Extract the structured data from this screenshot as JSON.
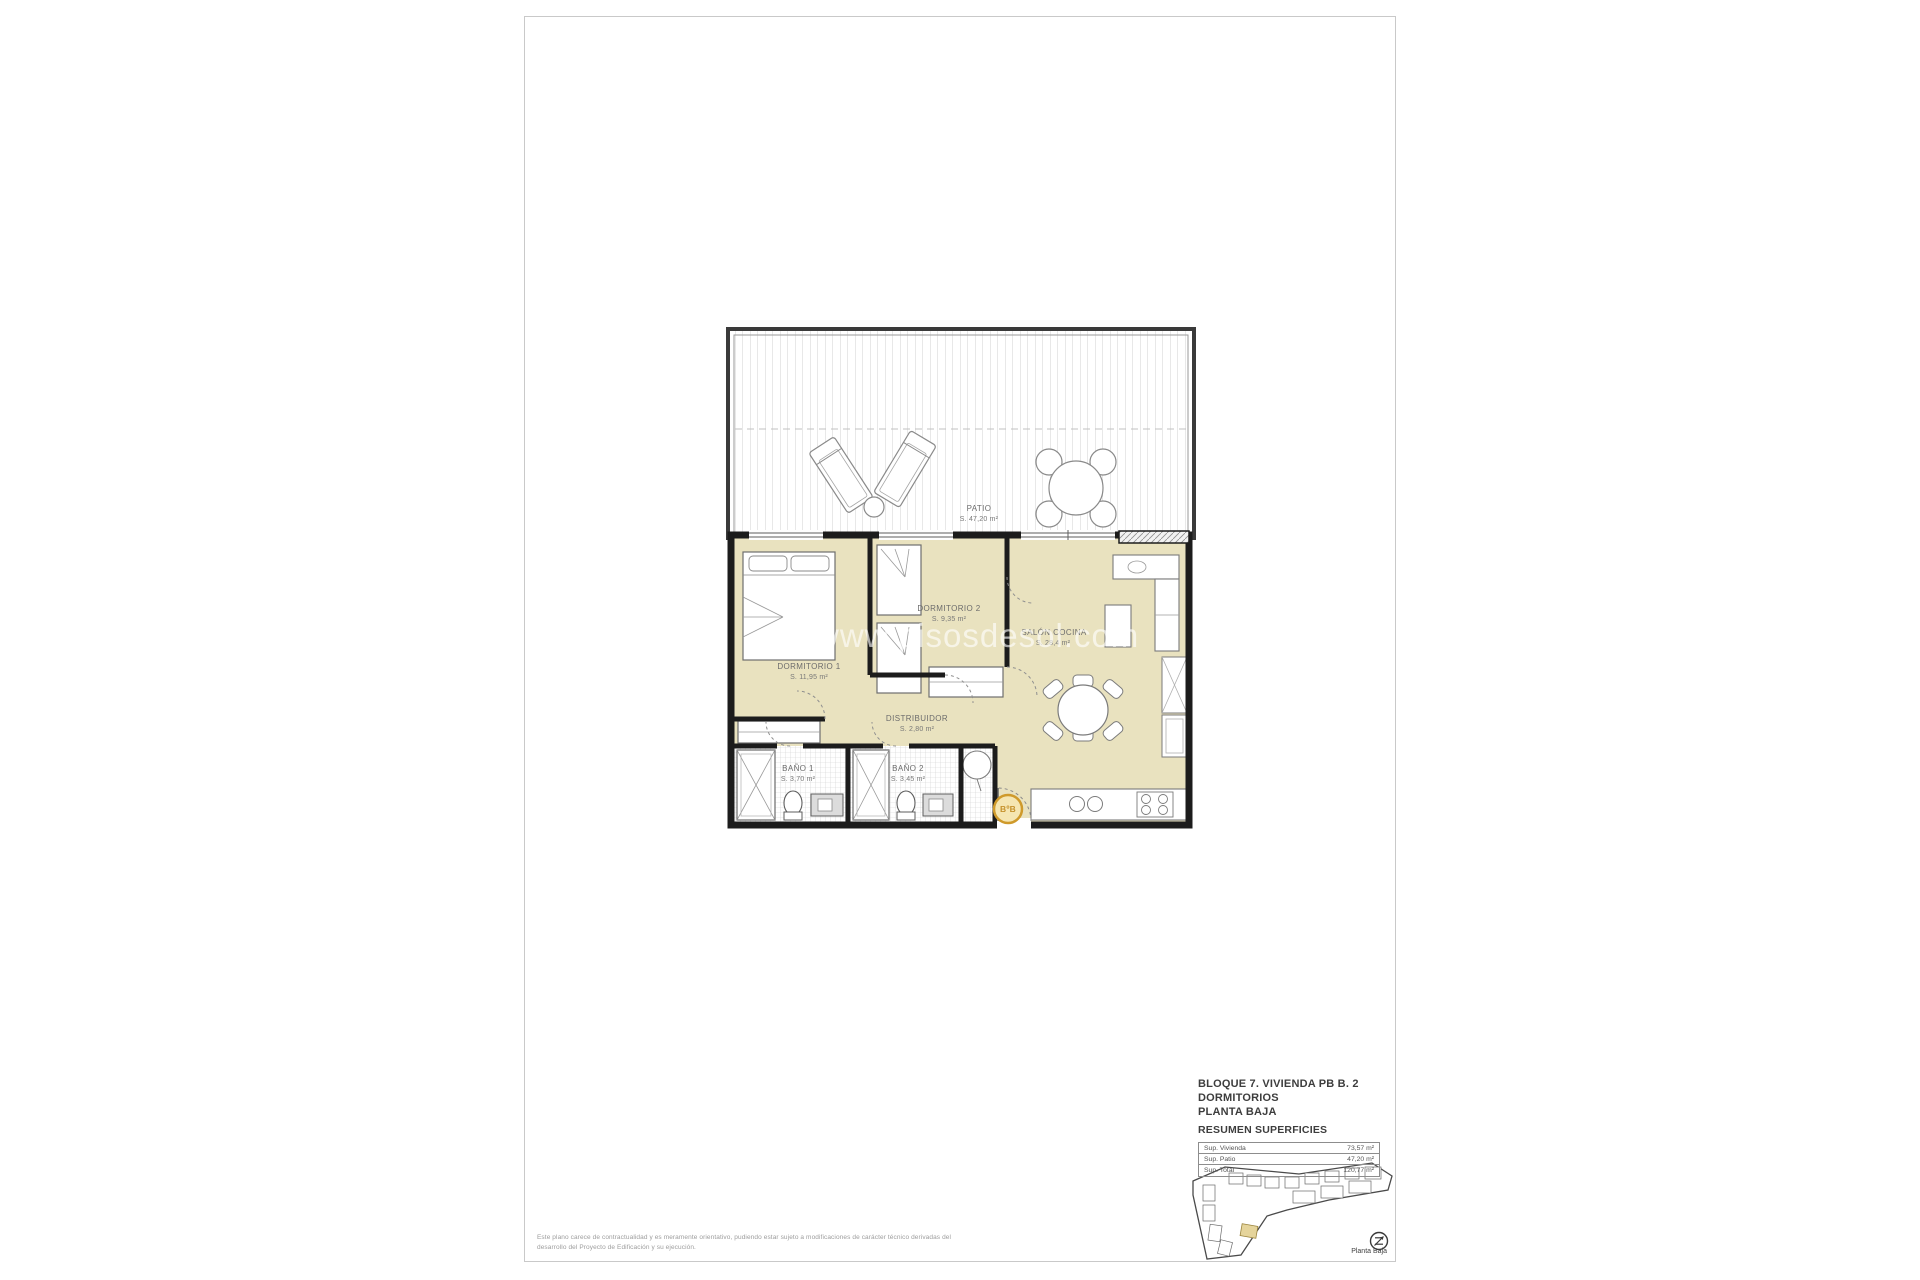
{
  "plan": {
    "watermark": "www.pisosdesol.com",
    "rooms": {
      "patio": {
        "name": "PATIO",
        "area": "S. 47,20 m²"
      },
      "dormitorio1": {
        "name": "DORMITORIO 1",
        "area": "S. 11,95 m²"
      },
      "dormitorio2": {
        "name": "DORMITORIO 2",
        "area": "S. 9,35 m²"
      },
      "distribuidor": {
        "name": "DISTRIBUIDOR",
        "area": "S. 2,80 m²"
      },
      "bano1": {
        "name": "BAÑO 1",
        "area": "S. 3,70 m²"
      },
      "bano2": {
        "name": "BAÑO 2",
        "area": "S. 3,45 m²"
      },
      "salon": {
        "name": "SALÓN COCINA",
        "area": "S. 28,4 m²"
      }
    },
    "entry_badge": "BºB"
  },
  "title_block": {
    "line1": "BLOQUE 7. VIVIENDA PB B. 2 DORMITORIOS",
    "line2": "PLANTA BAJA",
    "line3": "RESUMEN SUPERFICIES",
    "table": {
      "rows": [
        {
          "label": "Sup. Vivienda",
          "value": "73,57 m²"
        },
        {
          "label": "Sup. Patio",
          "value": "47,20 m²"
        },
        {
          "label": "Sup. Total",
          "value": "120,77 m²"
        }
      ]
    },
    "site_plan_caption": "Planta Baja"
  },
  "footer": {
    "disclaimer_line1": "Este plano carece de contractualidad y es meramente orientativo, pudiendo estar sujeto a modificaciones de carácter técnico derivadas del",
    "disclaimer_line2": "desarrollo del Proyecto de Edificación y su ejecución."
  },
  "colors": {
    "room_fill": "#e9e2bf",
    "wall": "#1c1c1c",
    "accent_orange": "#cf9a2b",
    "hatch_gray": "#d2d2d2"
  }
}
